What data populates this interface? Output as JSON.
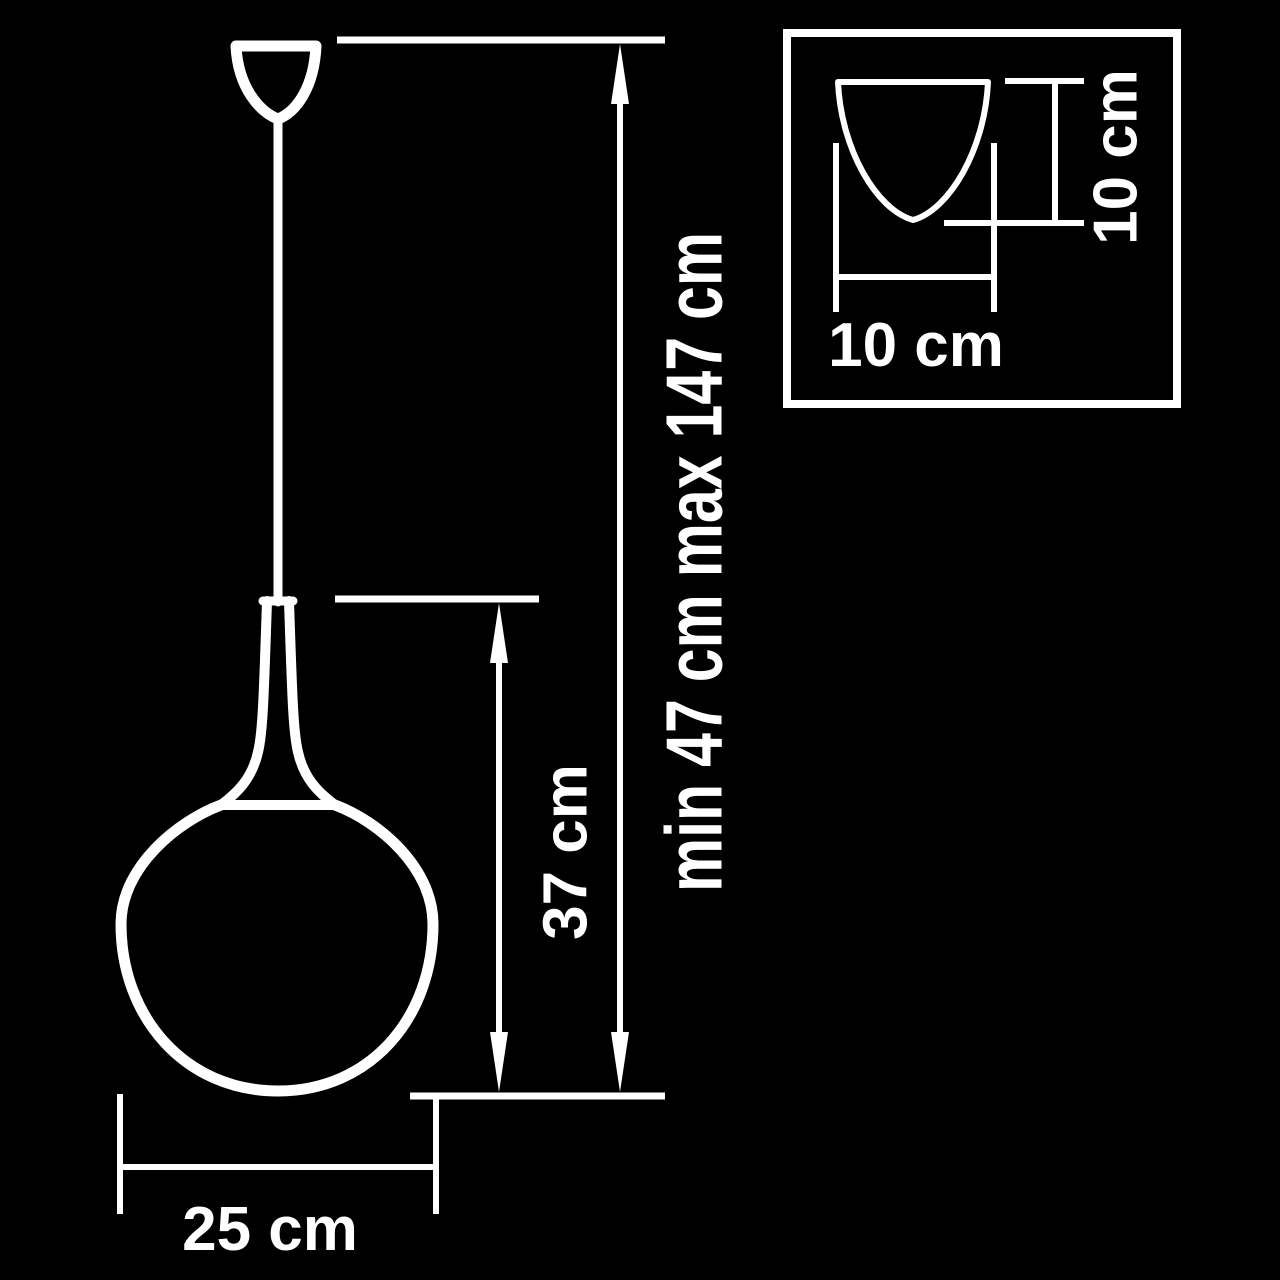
{
  "diagram": {
    "kind": "pendant-lamp-dimension-drawing",
    "colors": {
      "background": "#000000",
      "line": "#ffffff",
      "text": "#ffffff"
    },
    "labels": {
      "suspension_height_range": "min 47 cm max 147 cm",
      "shade_height": "37 cm",
      "shade_diameter": "25 cm",
      "canopy_width": "10 cm",
      "canopy_height": "10 cm"
    }
  }
}
